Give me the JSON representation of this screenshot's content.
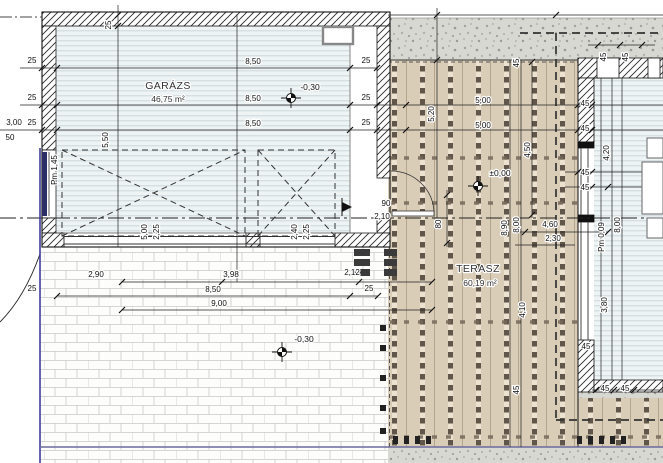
{
  "drawing": {
    "type": "architectural-floor-plan",
    "rooms": {
      "garage": {
        "name": "GARÁZS",
        "area": "46,75 m²"
      },
      "terrace": {
        "name": "TERASZ",
        "area": "60,19 m²"
      }
    },
    "levels": {
      "garage": "-0,30",
      "terrace": "±0,00",
      "paving": "-0,30"
    },
    "colors": {
      "deck_tan": "#d9cdb7",
      "floor_stripe": "#d6e0e3",
      "gravel": "#d8d8d3",
      "boundary_blue": "#3f3f96",
      "line_dark": "#1c1c1c"
    },
    "dimension_labels": [
      {
        "text": "8,50",
        "x": 253,
        "y": 64
      },
      {
        "text": "8,50",
        "x": 253,
        "y": 101
      },
      {
        "text": "8,50",
        "x": 253,
        "y": 126
      },
      {
        "text": "25",
        "x": 366,
        "y": 63
      },
      {
        "text": "25",
        "x": 366,
        "y": 100
      },
      {
        "text": "25",
        "x": 366,
        "y": 125
      },
      {
        "text": "25",
        "x": 32,
        "y": 63
      },
      {
        "text": "25",
        "x": 32,
        "y": 100
      },
      {
        "text": "25",
        "x": 32,
        "y": 125
      },
      {
        "text": "3,00",
        "x": 14,
        "y": 125
      },
      {
        "text": "50",
        "x": 10,
        "y": 140
      },
      {
        "text": "25",
        "x": 111,
        "y": 25,
        "rot": -90
      },
      {
        "text": "5,50",
        "x": 108,
        "y": 140,
        "rot": -90
      },
      {
        "text": "Pm 1,45",
        "x": 57,
        "y": 170,
        "rot": -90
      },
      {
        "text": "5,00",
        "x": 147,
        "y": 232,
        "rot": -90
      },
      {
        "text": "2,25",
        "x": 159,
        "y": 232,
        "rot": -90
      },
      {
        "text": "2,40",
        "x": 297,
        "y": 232,
        "rot": -90
      },
      {
        "text": "2,25",
        "x": 309,
        "y": 232,
        "rot": -90
      },
      {
        "text": "2,90",
        "x": 96,
        "y": 277
      },
      {
        "text": "3,98",
        "x": 231,
        "y": 277
      },
      {
        "text": "2,12",
        "x": 352,
        "y": 275
      },
      {
        "text": "8,50",
        "x": 213,
        "y": 292
      },
      {
        "text": "25",
        "x": 369,
        "y": 291
      },
      {
        "text": "25",
        "x": 32,
        "y": 291
      },
      {
        "text": "9,00",
        "x": 219,
        "y": 306
      },
      {
        "text": "5,00",
        "x": 483,
        "y": 103
      },
      {
        "text": "5,00",
        "x": 483,
        "y": 128
      },
      {
        "text": "5,20",
        "x": 434,
        "y": 114,
        "rot": -90
      },
      {
        "text": "4,50",
        "x": 530,
        "y": 150,
        "rot": -90
      },
      {
        "text": "45",
        "x": 519,
        "y": 63,
        "rot": -90
      },
      {
        "text": "45",
        "x": 606,
        "y": 57,
        "rot": -90
      },
      {
        "text": "45",
        "x": 628,
        "y": 57,
        "rot": -90
      },
      {
        "text": "45",
        "x": 585,
        "y": 106
      },
      {
        "text": "45",
        "x": 585,
        "y": 131
      },
      {
        "text": "45",
        "x": 585,
        "y": 175
      },
      {
        "text": "45",
        "x": 585,
        "y": 190
      },
      {
        "text": "80",
        "x": 441,
        "y": 224,
        "rot": -90
      },
      {
        "text": "90",
        "x": 386,
        "y": 206
      },
      {
        "text": "2,10",
        "x": 382,
        "y": 219
      },
      {
        "text": "4,60",
        "x": 550,
        "y": 227
      },
      {
        "text": "2,30",
        "x": 553,
        "y": 241
      },
      {
        "text": "8,90",
        "x": 507,
        "y": 228,
        "rot": -90
      },
      {
        "text": "8,00",
        "x": 519,
        "y": 225,
        "rot": -90
      },
      {
        "text": "8,00",
        "x": 620,
        "y": 225,
        "rot": -90
      },
      {
        "text": "Pm 0,09",
        "x": 604,
        "y": 237,
        "rot": -90
      },
      {
        "text": "4,20",
        "x": 609,
        "y": 153,
        "rot": -90
      },
      {
        "text": "4,10",
        "x": 525,
        "y": 310,
        "rot": -90
      },
      {
        "text": "3,80",
        "x": 607,
        "y": 305,
        "rot": -90
      },
      {
        "text": "45",
        "x": 519,
        "y": 390,
        "rot": -90
      },
      {
        "text": "45",
        "x": 586,
        "y": 349
      },
      {
        "text": "45",
        "x": 605,
        "y": 391
      },
      {
        "text": "45",
        "x": 625,
        "y": 391
      }
    ]
  }
}
